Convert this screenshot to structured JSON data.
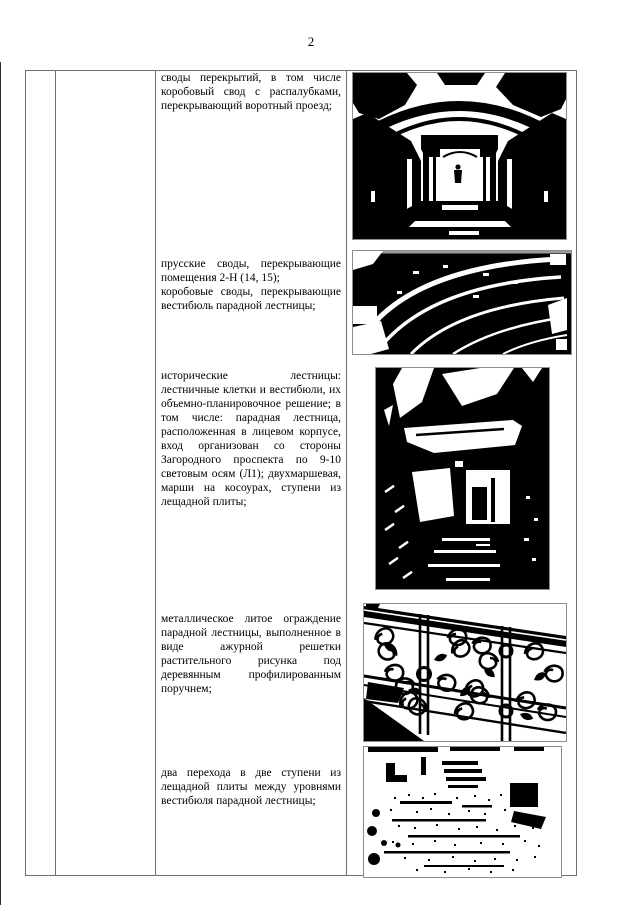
{
  "page_number": "2",
  "table": {
    "rows": [
      {
        "paragraphs": [
          "своды перекрытий, в том числе коробовый свод с распалубками, перекрывающий воротный проезд;"
        ],
        "photo_alt": "черно-белое фото: коробовый свод с распалубками над воротным проездом"
      },
      {
        "paragraphs": [
          "прусские своды, перекрывающие помещения 2-Н (14, 15);",
          "коробовые своды, перекрывающие вестибюль парадной лестницы;"
        ],
        "photo_alt": "черно-белое фото: прусские и коробовые своды вестибюля"
      },
      {
        "paragraphs": [
          "исторические лестницы: лестничные клетки и вестибюли, их объемно-планировочное решение; в том числе: парадная лестница, расположенная в лицевом корпусе, вход организован со стороны Загородного проспекта по 9-10 световым осям (Л1); двухмаршевая, марши на косоурах, ступени из лещадной плиты;"
        ],
        "photo_alt": "черно-белое фото: парадная лестница, марши на косоурах"
      },
      {
        "paragraphs": [
          "металлическое литое ограждение парадной лестницы, выполненное в виде ажурной решетки растительного рисунка под деревянным профилированным поручнем;"
        ],
        "photo_alt": "черно-белое фото: литое ажурное ограждение парадной лестницы"
      },
      {
        "paragraphs": [
          "два перехода в две ступени из лещадной плиты между уровнями вестибюля парадной лестницы;"
        ],
        "photo_alt": "черно-белое фото: ступени из лещадной плиты между уровнями вестибюля"
      }
    ]
  },
  "colors": {
    "ink": "#000000",
    "table_border": "#6e6e6e",
    "photo_frame": "#8d8d8d",
    "background": "#ffffff"
  }
}
